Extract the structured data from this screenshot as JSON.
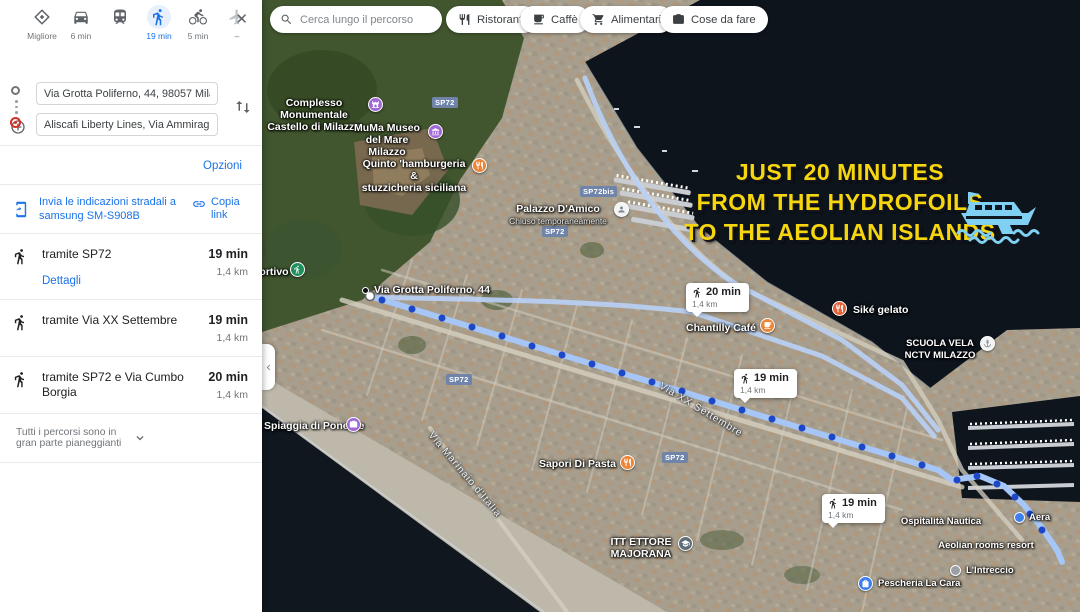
{
  "sidebar": {
    "modes": {
      "best_label": "Migliore",
      "car_label": "6 min",
      "transit_label": "",
      "walk_label": "19 min",
      "bike_label": "5 min",
      "plane_label": "–"
    },
    "origin_value": "Via Grotta Poliferno, 44, 98057 Milazzo MI",
    "destination_value": "Aliscafi Liberty Lines, Via Ammiraglio Luig",
    "add_destination_label": "Aggiungi destinazione",
    "options_label": "Opzioni",
    "send_label": "Invia le indicazioni stradali a samsung SM-S908B",
    "copy_link_label": "Copia link",
    "routes": [
      {
        "via": "tramite SP72",
        "time": "19 min",
        "dist": "1,4 km",
        "details_label": "Dettagli"
      },
      {
        "via": "tramite Via XX Settembre",
        "time": "19 min",
        "dist": "1,4 km"
      },
      {
        "via": "tramite SP72 e Via Cumbo Borgia",
        "time": "20 min",
        "dist": "1,4 km"
      }
    ],
    "footer_note": "Tutti i percorsi sono in gran parte pianeggianti"
  },
  "map": {
    "search_placeholder": "Cerca lungo il percorso",
    "chips": [
      {
        "label": "Ristoranti",
        "icon": "restaurant-icon"
      },
      {
        "label": "Caffè",
        "icon": "cafe-icon"
      },
      {
        "label": "Alimentari",
        "icon": "cart-icon"
      },
      {
        "label": "Cose da fare",
        "icon": "camera-icon"
      }
    ],
    "overlay": {
      "line1": "JUST 20 MINUTES",
      "line2": "FROM THE HYDROFOILS",
      "line3": "TO THE AEOLIAN ISLANDS"
    },
    "time_badges": [
      {
        "time": "20 min",
        "dist": "1,4 km"
      },
      {
        "time": "19 min",
        "dist": "1,4 km"
      },
      {
        "time": "19 min",
        "dist": "1,4 km"
      }
    ],
    "road_badges": [
      {
        "label": "SP72"
      },
      {
        "label": "SP72bis"
      },
      {
        "label": "SP72"
      },
      {
        "label": "SP72"
      },
      {
        "label": "SP72"
      }
    ],
    "street_labels": [
      {
        "name": "Via XX Settembre"
      },
      {
        "name": "Via Marinaio d'Italia"
      }
    ],
    "pois": [
      {
        "name": "Complesso Monumentale",
        "name2": "Castello di Milazzo"
      },
      {
        "name": "MuMa Museo",
        "name2": "del Mare Milazzo"
      },
      {
        "name": "Quinto 'hamburgeria &",
        "name2": "stuzzicheria siciliana"
      },
      {
        "name": "Palazzo D'Amico",
        "sub": "Chiuso temporaneamente"
      },
      {
        "name": "Sportivo"
      },
      {
        "name": "Via Grotta Poliferno, 44"
      },
      {
        "name": "Chantilly Café"
      },
      {
        "name": "Siké gelato"
      },
      {
        "name": "SCUOLA VELA",
        "name2": "NCTV MILAZZO"
      },
      {
        "name": "Spiaggia di Ponente"
      },
      {
        "name": "Sapori Di Pasta"
      },
      {
        "name": "ITT ETTORE",
        "name2": "MAJORANA"
      },
      {
        "name": "Ospitalità Nautica"
      },
      {
        "name": "Aeolian rooms resort"
      },
      {
        "name": "L'Intreccio"
      },
      {
        "name": "Pescheria La Cara"
      },
      {
        "name": "Aera"
      }
    ],
    "colors": {
      "route_line": "#a6c6f8",
      "route_dot": "#1c47c8",
      "overlay_text": "#f6d60e",
      "boat": "#7fd0f3",
      "poi_purple": "#a168d6",
      "poi_orange": "#ee8435",
      "poi_red_orange": "#e2633a",
      "poi_green": "#1f8f5f",
      "poi_blue": "#3d7ff0",
      "sea": "#0d141c",
      "accent_blue": "#1a73e8"
    }
  }
}
